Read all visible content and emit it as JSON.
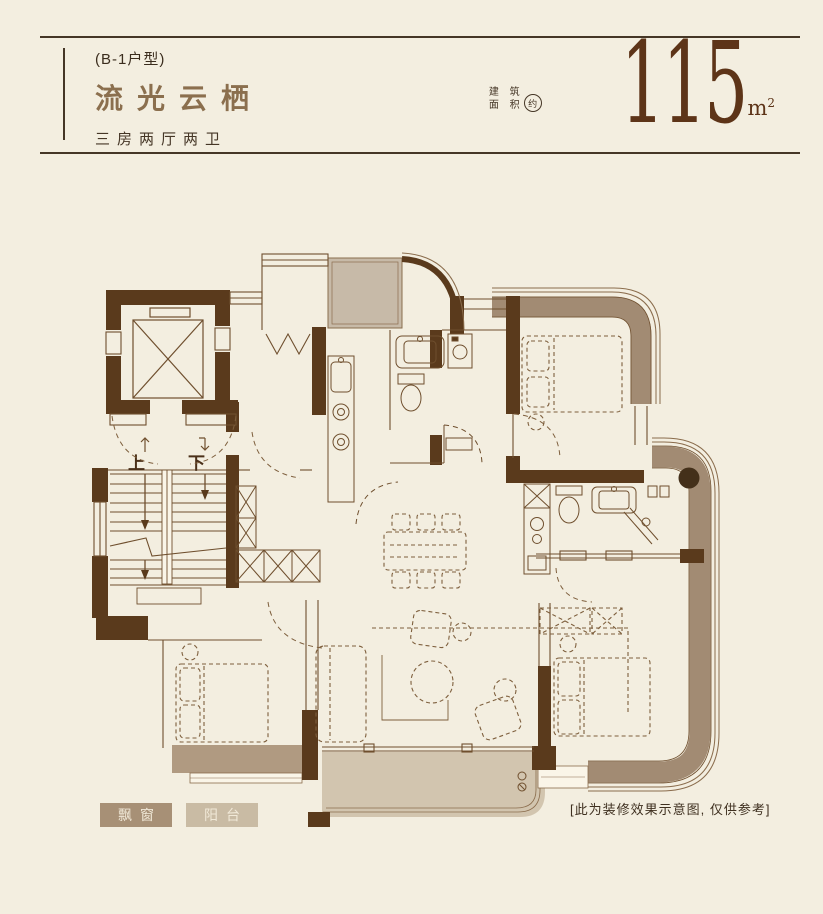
{
  "header": {
    "unit_tag": "(B-1户型)",
    "title": "流光云栖",
    "subtitle": "三房两厅两卫",
    "area_label_line1": "建 筑",
    "area_label_line2": "面 积",
    "area_approx": "约",
    "area_value": "115",
    "area_unit": "m",
    "area_unit_sup": "2"
  },
  "plan": {
    "stairs_up": "上",
    "stairs_down": "下"
  },
  "legend": {
    "bay_window": "飘窗",
    "balcony": "阳台"
  },
  "disclaimer": "[此为装修效果示意图, 仅供参考]",
  "colors": {
    "background": "#f3eee0",
    "wall_dark": "#5a3a1c",
    "exterior_band": "#a28b73",
    "flue_fill": "#c7baa8",
    "bay_window_fill": "#b09a81",
    "balcony_fill": "#d2c5af",
    "thin_line": "#6f4f2e",
    "furniture_line": "#7e5f3d",
    "title_color": "#8b6f4e",
    "number_color": "#5d3418",
    "legend_bay_bg": "#a79076",
    "legend_balcony_bg": "#c9bba4"
  }
}
